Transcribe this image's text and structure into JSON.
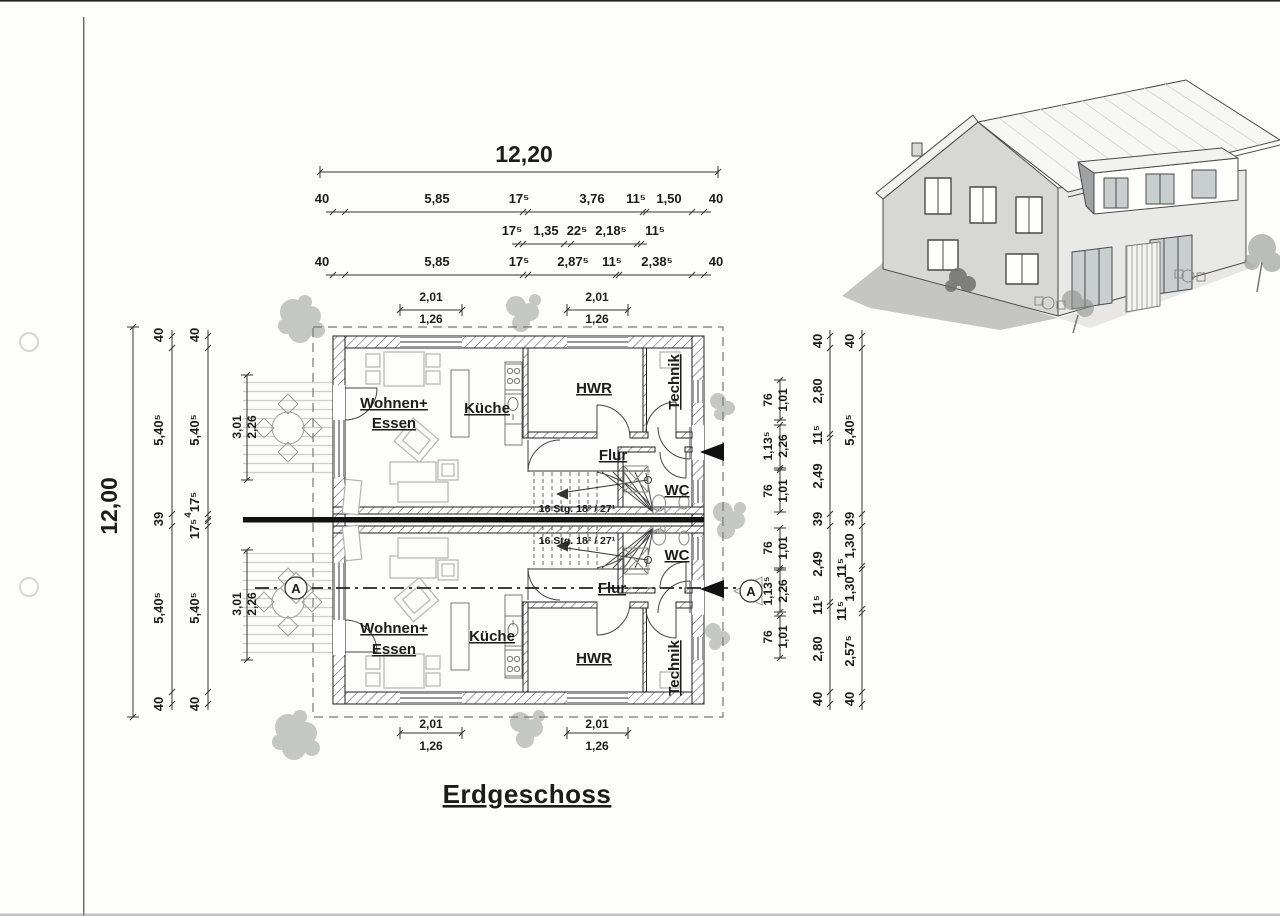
{
  "document": {
    "title": "Erdgeschoss",
    "stair_label": "16 Stg. 18² / 27¹",
    "section_marker": "A"
  },
  "colors": {
    "paper": "#fdfdfb",
    "ink": "#1c1c1c",
    "wall_hatch": "#555555",
    "party_wall_core": "#111111",
    "house3d_wall": "#d7d7d5",
    "house3d_roof": "#f7f7f5",
    "shadow": "#c5c5c3",
    "vegetation": "#8e938e"
  },
  "dimensions": {
    "top": {
      "overall": "12,20",
      "chain_main": [
        "40",
        "5,85",
        "17⁵",
        "3,76",
        "11⁵",
        "1,50",
        "40"
      ],
      "chain_detail": [
        "17⁵",
        "1,35",
        "22⁵",
        "2,18⁵",
        "11⁵"
      ],
      "chain_lower": [
        "40",
        "5,85",
        "17⁵",
        "2,87⁵",
        "11⁵",
        "2,38⁵",
        "40"
      ],
      "window_left": {
        "w": "2,01",
        "s": "1,26"
      },
      "window_right": {
        "w": "2,01",
        "s": "1,26"
      }
    },
    "bottom": {
      "window_left": {
        "w": "2,01",
        "s": "1,26"
      },
      "window_right": {
        "w": "2,01",
        "s": "1,26"
      }
    },
    "left": {
      "overall": "12,00",
      "chain_outer": [
        "40",
        "5,40⁵",
        "39",
        "5,40⁵",
        "40"
      ],
      "chain_inner": [
        "40",
        "5,40⁵",
        "17⁵",
        "4",
        "17⁵",
        "5,40⁵",
        "40"
      ],
      "terrace_top": {
        "w": "3,01",
        "s": "2,26"
      },
      "terrace_bottom": {
        "w": "3,01",
        "s": "2,26"
      }
    },
    "right": {
      "chain_outer": [
        "40",
        "5,40⁵",
        "39",
        "1,30",
        "11⁵",
        "1,30",
        "11⁵",
        "2,57⁵",
        "40"
      ],
      "chain_mid": [
        "40",
        "2,80",
        "11⁵",
        "2,49",
        "39",
        "2,49",
        "11⁵",
        "2,80",
        "40"
      ],
      "openings": [
        {
          "w": "76",
          "s": "1,01"
        },
        {
          "w": "1,13⁵",
          "s": "2,26"
        },
        {
          "w": "76",
          "s": "1,01"
        },
        {
          "w": "76",
          "s": "1,01"
        },
        {
          "w": "1,13⁵",
          "s": "2,26"
        },
        {
          "w": "76",
          "s": "1,01"
        }
      ]
    }
  },
  "rooms": {
    "unit_top": {
      "living1": "Wohnen+",
      "living2": "Essen",
      "kitchen": "Küche",
      "utility": "HWR",
      "technik": "Technik",
      "hall": "Flur",
      "wc": "WC"
    },
    "unit_bottom": {
      "living1": "Wohnen+",
      "living2": "Essen",
      "kitchen": "Küche",
      "utility": "HWR",
      "technik": "Technik",
      "hall": "Flur",
      "wc": "WC"
    }
  }
}
